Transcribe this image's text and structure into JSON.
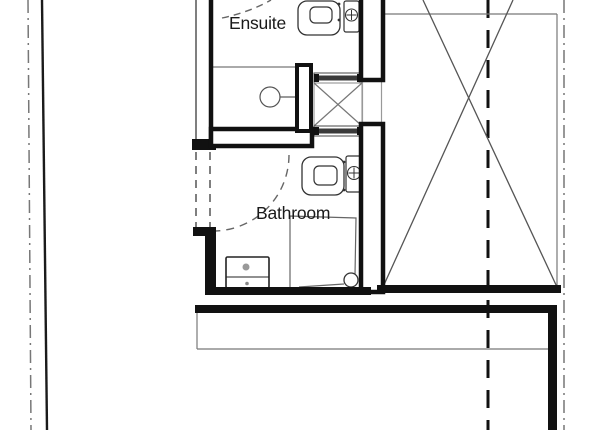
{
  "document": {
    "type": "architectural-floor-plan",
    "rooms": {
      "ensuite": {
        "label": "Ensuite"
      },
      "bathroom": {
        "label": "Bathroom"
      }
    },
    "fixtures": [
      "ensuite-toilet",
      "ensuite-wash-basin",
      "ensuite-shower-head",
      "bathroom-toilet",
      "bathroom-wash-basin",
      "bathroom-shower",
      "bathroom-vanity-unit"
    ],
    "symbols": [
      "void-cross-braced-area",
      "duct-shaft-cross",
      "wall-vent-hatched",
      "door-swing-dashed",
      "boundary-dash-dot-line",
      "section-dashed-line"
    ],
    "colors": {
      "background": "#ffffff",
      "wall": "#111111",
      "thin_line": "#666666",
      "light_line": "#888888",
      "text": "#1a1a1a"
    }
  }
}
